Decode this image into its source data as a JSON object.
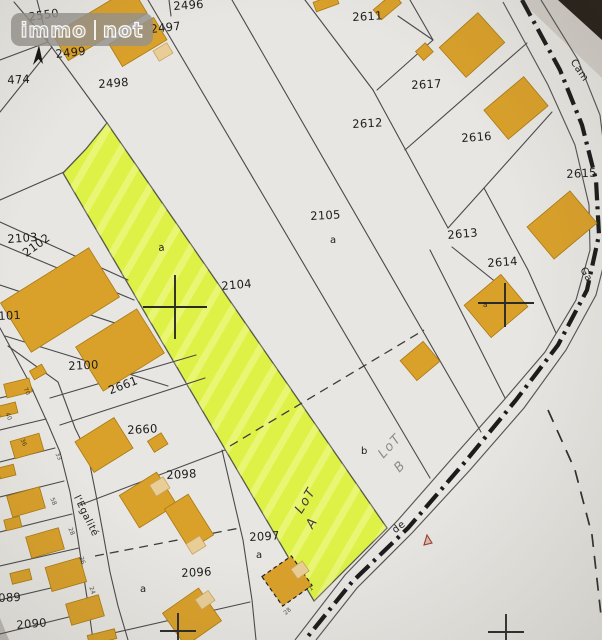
{
  "watermark": {
    "left": "immo",
    "right": "not"
  },
  "compass": {
    "label": "N"
  },
  "street": {
    "name": "l'Egalité"
  },
  "highlight": {
    "parcel": "2104",
    "lot_a": "LoT A",
    "lot_b": "LoT B"
  },
  "labels": {
    "parcels": [
      {
        "t": "2550",
        "x": 28,
        "y": 12,
        "r": -8
      },
      {
        "t": "2499",
        "x": 55,
        "y": 49,
        "r": -6
      },
      {
        "t": "474",
        "x": 7,
        "y": 75,
        "r": -3
      },
      {
        "t": "2498",
        "x": 98,
        "y": 79,
        "r": -4
      },
      {
        "t": "2497",
        "x": 150,
        "y": 24,
        "r": -6
      },
      {
        "t": "2496",
        "x": 173,
        "y": 1,
        "r": -4
      },
      {
        "t": "2611",
        "x": 352,
        "y": 12,
        "r": -3
      },
      {
        "t": "2617",
        "x": 411,
        "y": 80,
        "r": -3
      },
      {
        "t": "2612",
        "x": 352,
        "y": 119,
        "r": -3
      },
      {
        "t": "2616",
        "x": 461,
        "y": 133,
        "r": -4
      },
      {
        "t": "2615",
        "x": 566,
        "y": 169,
        "r": -3
      },
      {
        "t": "2105",
        "x": 310,
        "y": 211,
        "r": -3
      },
      {
        "t": "2613",
        "x": 447,
        "y": 230,
        "r": -5
      },
      {
        "t": "2614",
        "x": 487,
        "y": 258,
        "r": -4
      },
      {
        "t": "2104",
        "x": 221,
        "y": 281,
        "r": -5
      },
      {
        "t": "2103",
        "x": 7,
        "y": 234,
        "r": -4
      },
      {
        "t": "2102",
        "x": 21,
        "y": 250,
        "r": -36
      },
      {
        "t": "101",
        "x": -2,
        "y": 311,
        "r": -3
      },
      {
        "t": "2100",
        "x": 68,
        "y": 361,
        "r": -3
      },
      {
        "t": "2661",
        "x": 107,
        "y": 386,
        "r": -21
      },
      {
        "t": "2660",
        "x": 127,
        "y": 425,
        "r": -3
      },
      {
        "t": "2098",
        "x": 166,
        "y": 470,
        "r": -3
      },
      {
        "t": "2097",
        "x": 249,
        "y": 532,
        "r": -3
      },
      {
        "t": "2096",
        "x": 181,
        "y": 568,
        "r": -3
      },
      {
        "t": "089",
        "x": -2,
        "y": 593,
        "r": -3
      },
      {
        "t": "2090",
        "x": 16,
        "y": 620,
        "r": -5
      }
    ],
    "letters": [
      {
        "t": "a",
        "x": 330,
        "y": 236,
        "r": 0
      },
      {
        "t": "a",
        "x": 158,
        "y": 244,
        "r": -5
      },
      {
        "t": "a",
        "x": 256,
        "y": 551,
        "r": 0
      },
      {
        "t": "a",
        "x": 140,
        "y": 585,
        "r": 0
      },
      {
        "t": "b",
        "x": 361,
        "y": 447,
        "r": 0
      },
      {
        "t": "a",
        "x": 483,
        "y": 302,
        "r": 0,
        "s": 7
      }
    ],
    "tiny": [
      {
        "t": "70",
        "x": 27,
        "y": 387,
        "r": 64
      },
      {
        "t": "40",
        "x": 9,
        "y": 412,
        "r": 66
      },
      {
        "t": "36",
        "x": 24,
        "y": 438,
        "r": 66
      },
      {
        "t": "33",
        "x": 59,
        "y": 452,
        "r": 66
      },
      {
        "t": "58",
        "x": 54,
        "y": 497,
        "r": 68
      },
      {
        "t": "28",
        "x": 72,
        "y": 527,
        "r": 68
      },
      {
        "t": "26",
        "x": 83,
        "y": 556,
        "r": 70
      },
      {
        "t": "24",
        "x": 93,
        "y": 586,
        "r": 70
      },
      {
        "t": "1",
        "x": 308,
        "y": 588,
        "r": -40
      },
      {
        "t": "28",
        "x": 283,
        "y": 612,
        "r": -40
      }
    ],
    "handwriting": [
      {
        "t": "LoT",
        "x": 293,
        "y": 509,
        "r": -58,
        "c": "dark"
      },
      {
        "t": "A",
        "x": 304,
        "y": 524,
        "r": -58,
        "c": "dark"
      },
      {
        "t": "LoT",
        "x": 376,
        "y": 452,
        "r": -47,
        "c": "grey"
      },
      {
        "t": "B",
        "x": 392,
        "y": 466,
        "r": -47,
        "c": "grey"
      }
    ],
    "names": [
      {
        "t": "l'Egalité",
        "x": 80,
        "y": 494,
        "r": 64
      },
      {
        "t": "Cam",
        "x": 576,
        "y": 58,
        "r": 56
      },
      {
        "t": "Ga",
        "x": 586,
        "y": 266,
        "r": 60
      },
      {
        "t": "de",
        "x": 391,
        "y": 528,
        "r": -38
      },
      {
        "t": "N",
        "x": 32,
        "y": 30,
        "r": -8
      }
    ]
  },
  "colors": {
    "paper": "#e8e6e2",
    "line": "#4a4a4a",
    "building": "#d9a02a",
    "building_light": "#e8cd96",
    "highlight": "#ddf147",
    "hand_dark": "#3d3d3d",
    "hand_grey": "#8c8c8c",
    "red_mark": "#a03b2a"
  }
}
